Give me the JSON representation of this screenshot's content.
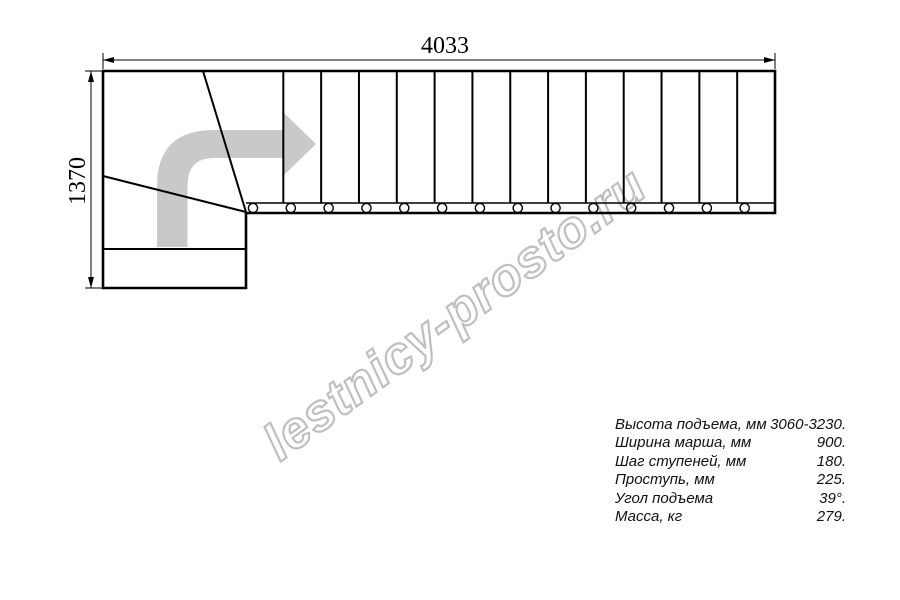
{
  "watermark": {
    "text": "lestnicy-prosto.ru"
  },
  "dimensions": {
    "width_label": "4033",
    "height_label": "1370"
  },
  "specs": {
    "rows": [
      {
        "label": "Высота подъема, мм",
        "value": "3060-3230."
      },
      {
        "label": "Ширина марша, мм",
        "value": "900."
      },
      {
        "label": "Шаг ступеней, мм",
        "value": "180."
      },
      {
        "label": "Проступь, мм",
        "value": "225."
      },
      {
        "label": "Угол подъема",
        "value": "39°."
      },
      {
        "label": "Масса, кг",
        "value": "279."
      }
    ]
  },
  "diagram": {
    "type": "staircase-plan",
    "description": "Plan view of L-shaped (quarter-turn) staircase with winder corner, straight flight and direction arrow",
    "flight_treads": 14,
    "winder_treads": 3,
    "turn_direction": "up-then-right",
    "colors": {
      "line": "#000000",
      "direction_arrow_fill": "#c9c9c9",
      "watermark_outline": "#bfbfbf",
      "background": "#ffffff"
    }
  }
}
